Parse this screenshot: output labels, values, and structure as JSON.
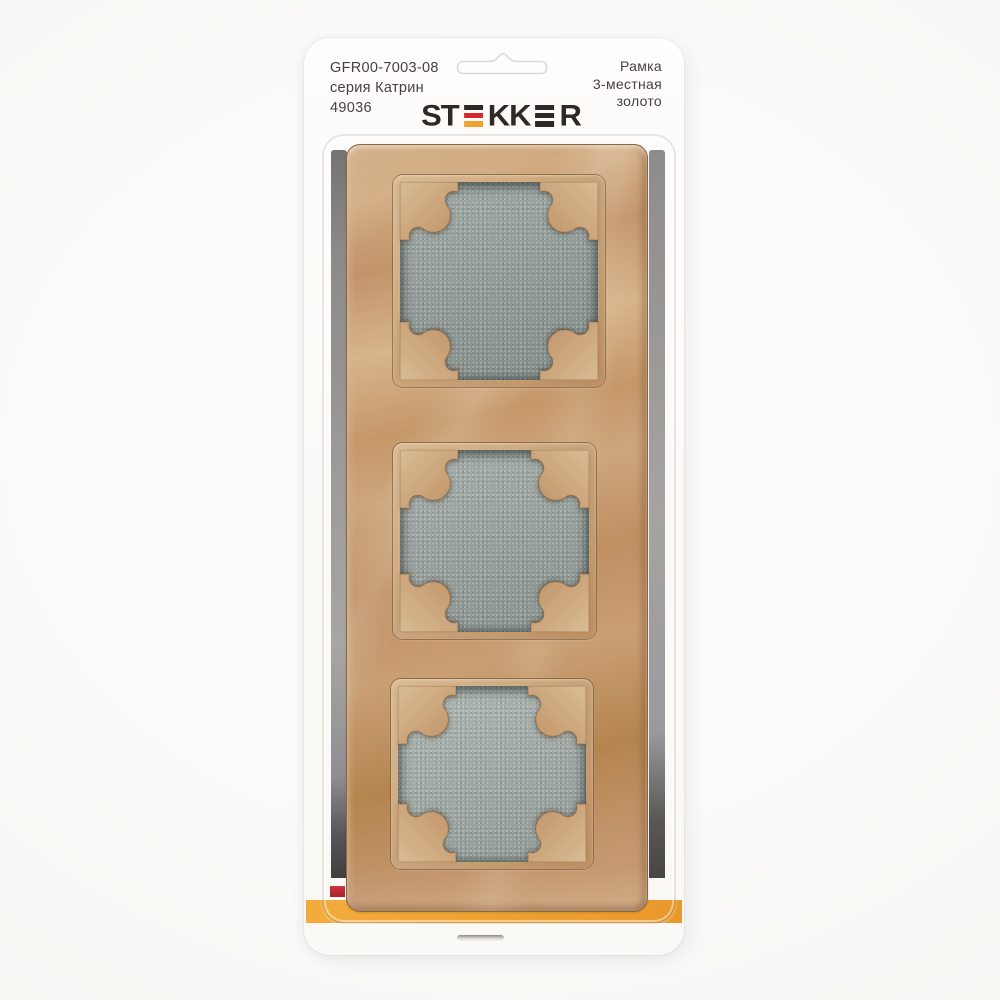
{
  "header": {
    "left_lines": [
      "GFR00-7003-08",
      "серия Катрин",
      "49036"
    ],
    "right_lines": [
      "Рамка",
      "3-местная",
      "золото"
    ],
    "text_color": "#45413d"
  },
  "brand": {
    "name": "STEKKER",
    "logo_part_st": "ST",
    "logo_part_kk": "KK",
    "logo_part_r": "R",
    "logo_colors": {
      "letters": "#2f2924",
      "e_bar_red": "#d4282c",
      "e_bar_yellow": "#efa22f"
    }
  },
  "product": {
    "article": "GFR00-7003-08",
    "series": "серия Катрин",
    "sku": "49036",
    "type": "Рамка",
    "gang": "3-местная",
    "finish": "золото",
    "windows_count": 3,
    "frame_color_hex": "#c49a6e",
    "insert_color_hex": "#97a19d"
  },
  "packaging": {
    "card_color": "#fdfcfa",
    "accent_band_color": "#f0a433",
    "stripe_red_color": "#c02e36",
    "blister_shadow_color": "#8a8886"
  }
}
